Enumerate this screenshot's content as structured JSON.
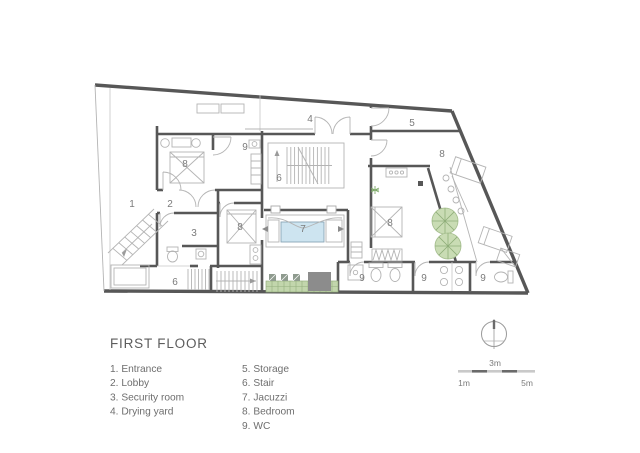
{
  "title": "FIRST FLOOR",
  "legend": {
    "col1": [
      "1. Entrance",
      "2. Lobby",
      "3. Security room",
      "4. Drying yard"
    ],
    "col2": [
      "5. Storage",
      "6. Stair",
      "7. Jacuzzi",
      "8. Bedroom",
      "9. WC"
    ]
  },
  "room_labels": [
    {
      "num": "1",
      "name": "Entrance"
    },
    {
      "num": "2",
      "name": "Lobby"
    },
    {
      "num": "3",
      "name": "Security room"
    },
    {
      "num": "4",
      "name": "Drying yard"
    },
    {
      "num": "5",
      "name": "Storage"
    },
    {
      "num": "6",
      "name": "Stair"
    },
    {
      "num": "6",
      "name": "Stair"
    },
    {
      "num": "7",
      "name": "Jacuzzi"
    },
    {
      "num": "8",
      "name": "Bedroom"
    },
    {
      "num": "8",
      "name": "Bedroom"
    },
    {
      "num": "8",
      "name": "Bedroom"
    },
    {
      "num": "8",
      "name": "Bedroom"
    },
    {
      "num": "9",
      "name": "WC"
    },
    {
      "num": "9",
      "name": "WC"
    },
    {
      "num": "9",
      "name": "WC"
    },
    {
      "num": "9",
      "name": "WC"
    }
  ],
  "scale_bar": {
    "above": "3m",
    "left": "1m",
    "right": "5m"
  },
  "icons": [
    "north-compass-icon",
    "tree-icon",
    "plant-icon"
  ],
  "colors": {
    "wall": "#575757",
    "detail_line": "#b4b4b4",
    "jacuzzi_water": "#cde4f0",
    "tree_fill": "#c9dcb4",
    "tree_line": "#8fae79",
    "planter": "#c2d6ac",
    "label_text": "#7b7b7b"
  }
}
